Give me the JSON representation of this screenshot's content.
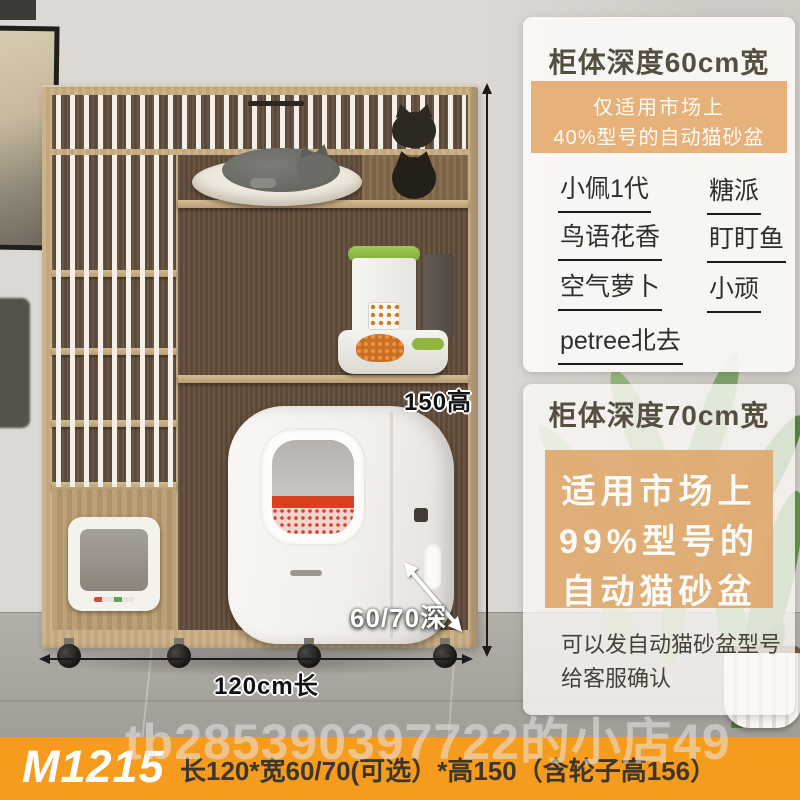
{
  "product_image": {
    "dimensions": {
      "height_label": "150高",
      "length_label": "120cm长",
      "depth_label": "60/70深"
    }
  },
  "info_cards": [
    {
      "title": "柜体深度60cm宽",
      "highlight_note": {
        "line1": "仅适用市场上",
        "line2": "40%型号的自动猫砂盆"
      },
      "compatible_models_left": [
        "小佩1代",
        "鸟语花香",
        "空气萝卜",
        "petree北去"
      ],
      "compatible_models_right": [
        "糖派",
        "盯盯鱼",
        "小顽"
      ]
    },
    {
      "title": "柜体深度70cm宽",
      "highlight_note": {
        "line1": "适用市场上",
        "line2": "99%型号的",
        "line3": "自动猫砂盆"
      },
      "footer_note": {
        "line1": "可以发自动猫砂盆型号",
        "line2": "给客服确认"
      }
    }
  ],
  "bottom_bar": {
    "model_code": "M1215",
    "spec_text": "长120*宽60/70(可选）*高150（含轮子高156）"
  },
  "watermark_text": "tb285390397722的小店49",
  "colors": {
    "accent_orange": "#f59c1e",
    "note_box_orange": "#e4ab72",
    "card_bg": "#faf8f5",
    "wood": "#c9b089",
    "interior_wood": "#63503f",
    "litter_box_red": "#d8401f"
  }
}
